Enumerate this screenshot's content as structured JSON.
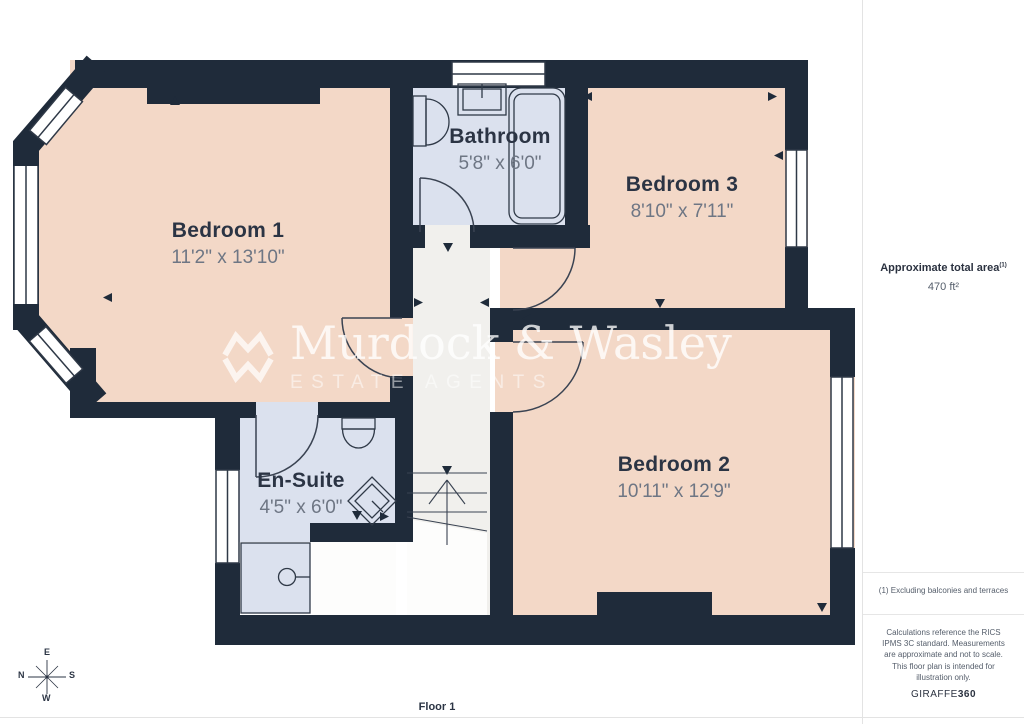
{
  "floorplan": {
    "floor_label": "Floor 1",
    "rooms": [
      {
        "name": "Bedroom 1",
        "dims": "11'2\" x 13'10\""
      },
      {
        "name": "Bathroom",
        "dims": "5'8\" x 6'0\""
      },
      {
        "name": "Bedroom 3",
        "dims": "8'10\" x 7'11\""
      },
      {
        "name": "Bedroom 2",
        "dims": "10'11\" x 12'9\""
      },
      {
        "name": "En-Suite",
        "dims": "4'5\" x 6'0\""
      }
    ],
    "compass": {
      "top": "E",
      "right": "S",
      "bottom": "W",
      "left": "N"
    }
  },
  "watermark": {
    "brand": "Murdock & Wasley",
    "tagline": "ESTATE AGENTS"
  },
  "sidebar": {
    "area_label": "Approximate total area",
    "area_footnote_marker": "(1)",
    "area_value": "470 ft²",
    "footnote": "(1) Excluding balconies and terraces",
    "disclaimer": "Calculations reference the RICS IPMS 3C standard. Measurements are approximate and not to scale. This floor plan is intended for illustration only.",
    "provider": "GIRAFFE",
    "provider_suffix": "360"
  },
  "colors": {
    "wall": "#1f2b3a",
    "room_fill": "#f3d8c7",
    "wet_room_fill": "#dbe1ee",
    "hallway_fill": "#f1f0ed",
    "label_text": "#2b3444",
    "dim_text": "#6e7684"
  }
}
